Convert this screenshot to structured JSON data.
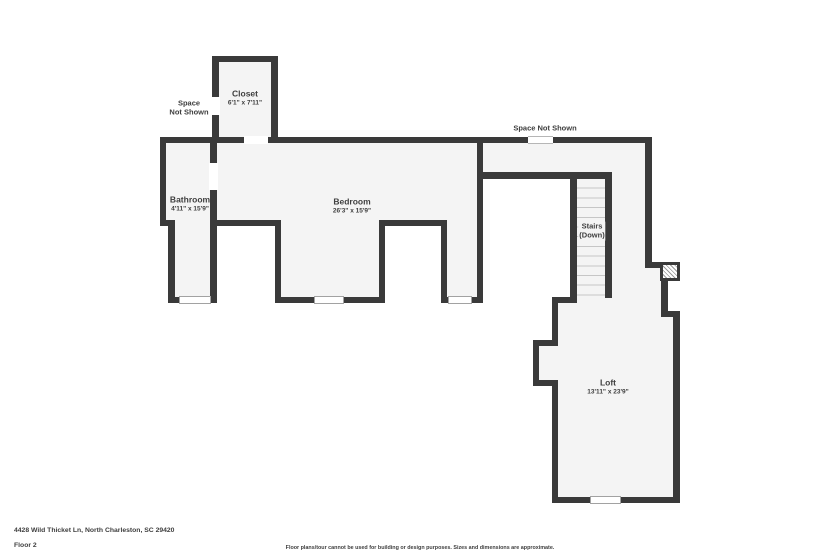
{
  "plan": {
    "rooms": [
      {
        "name": "Closet",
        "dims": "6'1\" x 7'11\""
      },
      {
        "name": "Bathroom",
        "dims": "4'11\" x 15'9\""
      },
      {
        "name": "Bedroom",
        "dims": "26'3\" x 15'9\""
      },
      {
        "name": "Stairs",
        "dims": "(Down)"
      },
      {
        "name": "Loft",
        "dims": "13'11\" x 23'9\""
      }
    ],
    "annotations": {
      "space_left_1": "Space",
      "space_left_2": "Not Shown",
      "space_right": "Space Not Shown"
    }
  },
  "footer": {
    "address": "4428 Wild Thicket Ln, North Charleston, SC 29420",
    "floor": "Floor 2",
    "disclaimer": "Floor plans/tour cannot be used for building or design purposes. Sizes and dimensions are approximate."
  },
  "colors": {
    "wall": "#3a3a3a",
    "floor": "#f4f4f4",
    "outside": "#ffffff",
    "text": "#3e3e3e",
    "tread_line": "#c6c6c6",
    "window_border": "#a2a2a2"
  }
}
